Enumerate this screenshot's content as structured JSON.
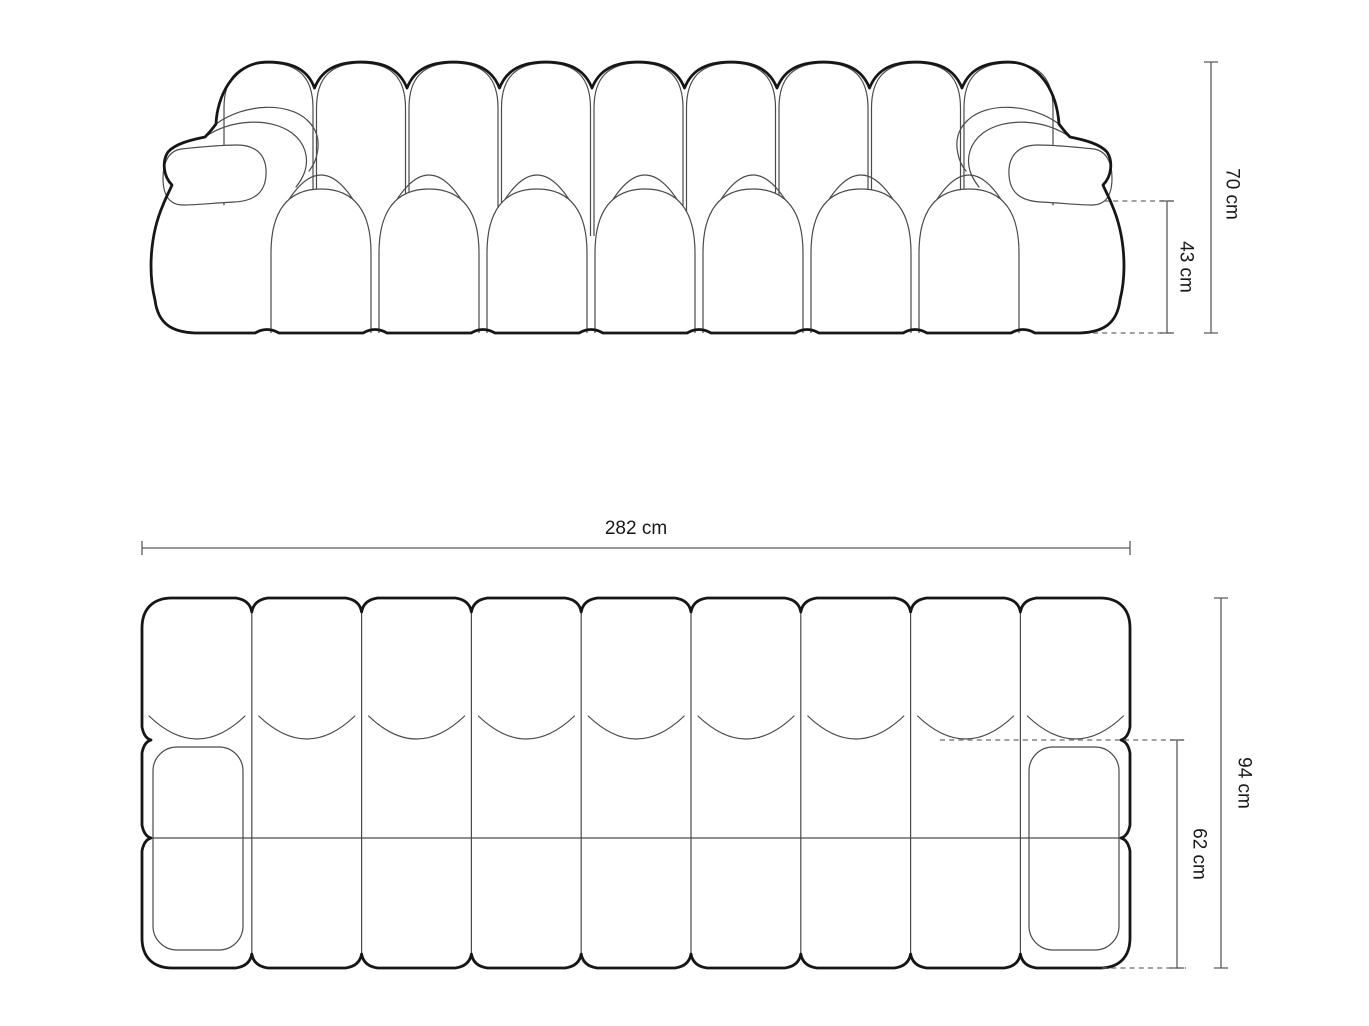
{
  "diagram": {
    "front_view": {
      "total_height_label": "70 cm",
      "seat_height_label": "43 cm"
    },
    "plan_view": {
      "width_label": "282 cm",
      "total_depth_label": "94 cm",
      "seat_depth_label": "62 cm"
    },
    "colors": {
      "background": "#ffffff",
      "outline": "#161616",
      "detail_line": "#4a4a4a",
      "dimension_line": "#5a5a5a",
      "label_text": "#181818"
    }
  }
}
